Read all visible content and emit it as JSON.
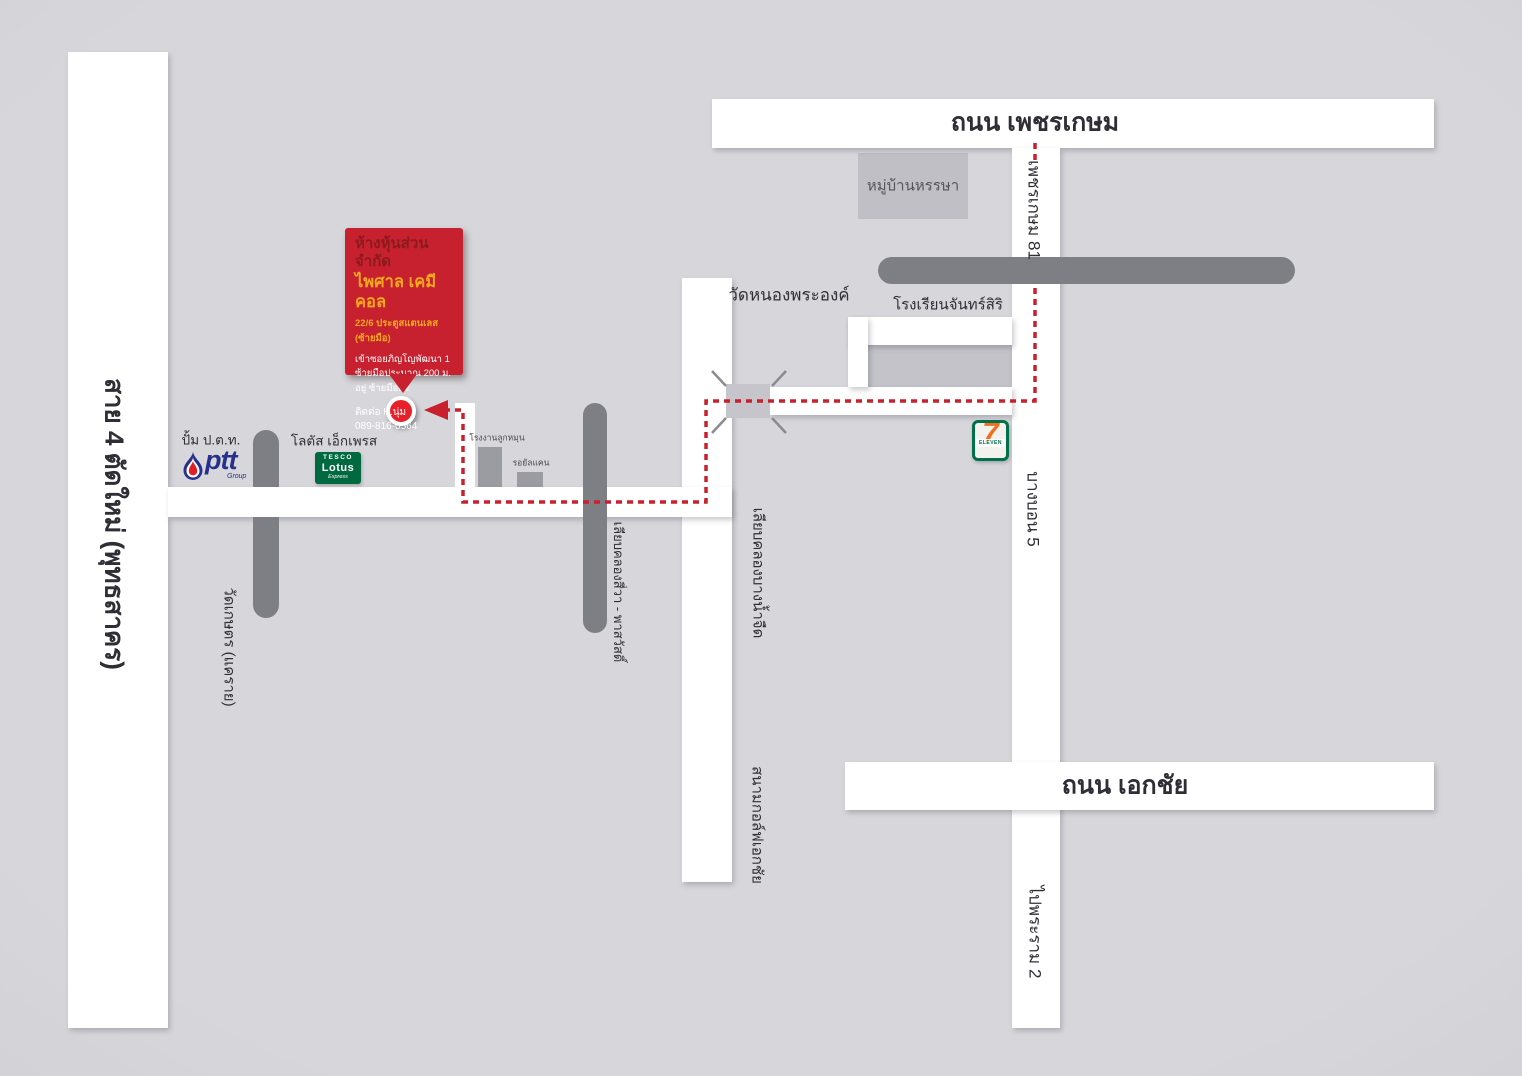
{
  "colors": {
    "background": "#d4d4d9",
    "road_white": "#ffffff",
    "bar_gray": "#7e7e85",
    "block_gray": "#bfbfc5",
    "route_red": "#c8202c",
    "callout_red": "#c7202f",
    "marker_red": "#e62129",
    "title_dark_red": "#8c1a1d",
    "title_yellow": "#f3a81e",
    "tesco_green": "#00693f",
    "seven_green": "#007148",
    "seven_orange": "#f26f21",
    "ptt_blue": "#27308b"
  },
  "roads": {
    "sai4": "สาย 4 ตัดใหม่ (พุทธสาคร)",
    "phetkasem": "ถนน เพชรเกษม",
    "phetkasem81": "เพชรเกษม 81",
    "bangbon5": "บางบอน 5",
    "to_rama2": "ไปพระราม 2",
    "ekachai": "ถนน เอกชัย",
    "liap_khlong_bangnamjued": "เลียบคลองบางน้ำจืด",
    "liap_khlong_siwa": "เลียบคลองสี่วา - พาสวัสดิ์",
    "wat_kaset": "วัดเกษตร (แคราย)"
  },
  "places": {
    "village": "หมู่บ้านหรรษา",
    "temple": "วัดหนองพระองค์",
    "school": "โรงเรียนจันทร์สิริ",
    "golf": "สนามกอล์ฟเอกชัย",
    "factory1": "โรงงานลูกหมุน",
    "factory2": "รอยัลแคน",
    "ptt_station": "ปั้ม ป.ต.ท.",
    "lotus_express": "โลตัส เอ็กเพรส"
  },
  "logos": {
    "ptt": {
      "wordmark": "ptt",
      "sub": "Group"
    },
    "tesco": {
      "line1": "TESCO",
      "line2": "Lotus",
      "line3": "Express"
    },
    "seven": {
      "digit": "7",
      "word": "ELEVEN"
    }
  },
  "callout": {
    "line1": "ห้างหุ้นส่วนจำกัด",
    "line2": "ไพศาล เคมีคอล",
    "line3": "22/6 ประตูสแตนเลส (ซ้ายมือ)",
    "line4": "เข้าซอยภิญโญพัฒนา 1",
    "line5": "ซ้ายมือประมาณ 200 ม.",
    "line6": "อยู่ ซ้ายมือค่ะ",
    "line7": "ติดต่อ K.นุ่ม",
    "line8": "089-816-0564"
  }
}
